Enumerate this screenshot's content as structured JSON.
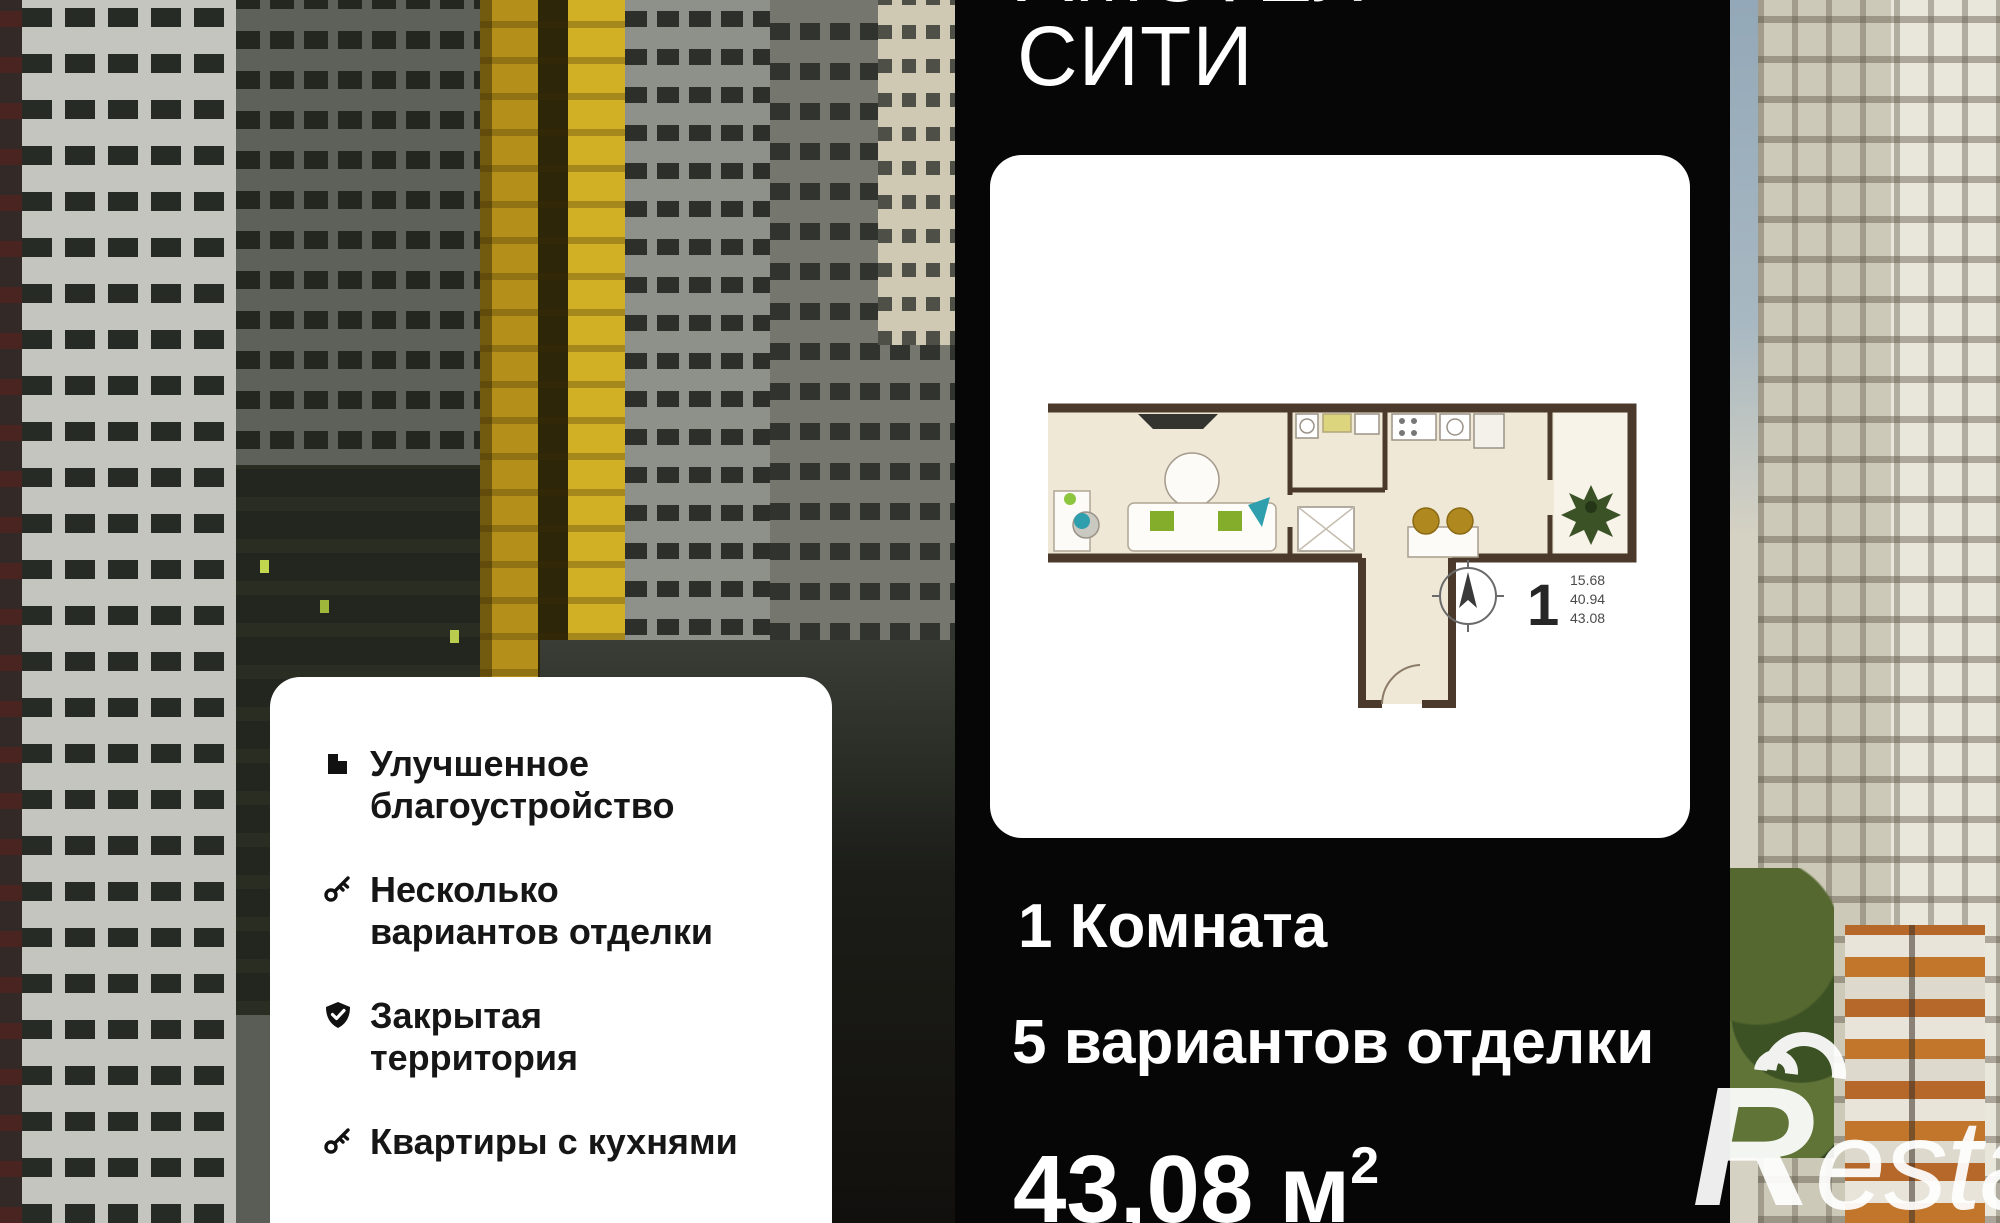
{
  "title": {
    "line1": "АМСТЕЛ",
    "line2": "СИТИ"
  },
  "stats": {
    "rooms": "1 Комната",
    "finishes": "5 вариантов отделки",
    "area_value": "43,08",
    "area_unit": "м",
    "area_exp": "2"
  },
  "floor_plan": {
    "rooms_big": "1",
    "area_line_1": "15.68",
    "area_line_2": "40.94",
    "area_line_3": "43.08"
  },
  "features": {
    "items": [
      {
        "icon": "building-icon",
        "label": "Улучшенное благоустройство"
      },
      {
        "icon": "key-icon",
        "label": "Несколько вариантов отделки"
      },
      {
        "icon": "shield-check-icon",
        "label": "Закрытая территория"
      },
      {
        "icon": "key-icon",
        "label": "Квартиры с кухнями"
      }
    ]
  },
  "watermark": {
    "r": "R",
    "rest": "estate"
  },
  "colors": {
    "panel_bg": "#070606",
    "card_bg": "#ffffff",
    "plan_wall": "#4b3a2b",
    "plan_floor": "#efe8d7",
    "accent_yellow": "#c29d1e",
    "text_dark": "#161616",
    "logo_white": "#ffffff"
  }
}
